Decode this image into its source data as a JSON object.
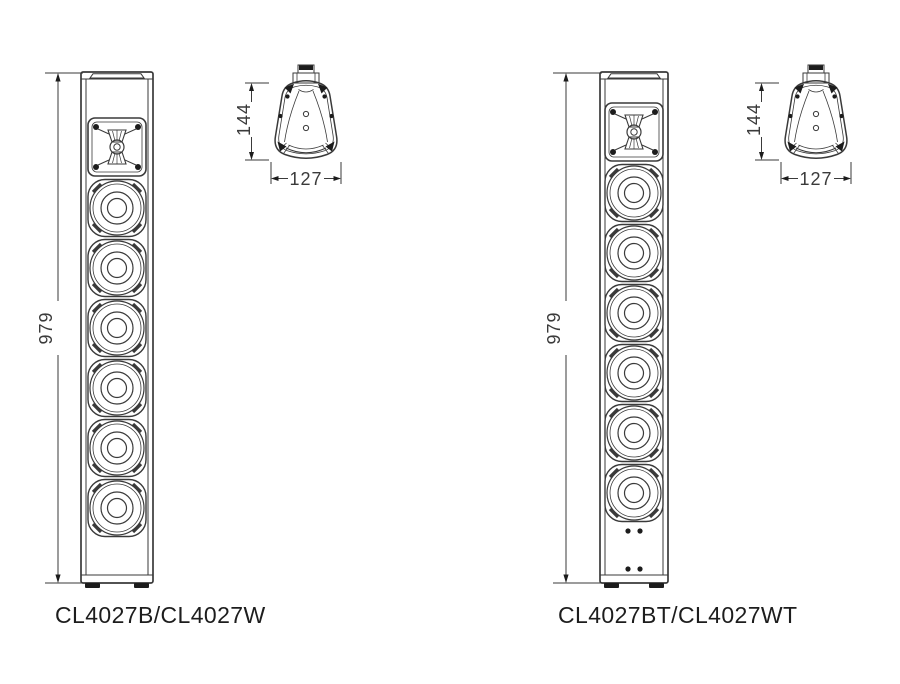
{
  "drawing": {
    "background": "#ffffff",
    "line_color": "#3a3a3a",
    "fill_color": "#1c1c1c",
    "text_color": "#1d1d1d"
  },
  "figures": [
    {
      "caption": "CL4027B/CL4027W",
      "front_view": {
        "height_dim": "979",
        "tweeters": 1,
        "woofers": 6,
        "bottom_terminal_dots": false
      },
      "top_view": {
        "depth_dim": "144",
        "width_dim": "127"
      }
    },
    {
      "caption": "CL4027BT/CL4027WT",
      "front_view": {
        "height_dim": "979",
        "tweeters": 1,
        "woofers": 6,
        "bottom_terminal_dots": true
      },
      "top_view": {
        "depth_dim": "144",
        "width_dim": "127"
      }
    }
  ]
}
